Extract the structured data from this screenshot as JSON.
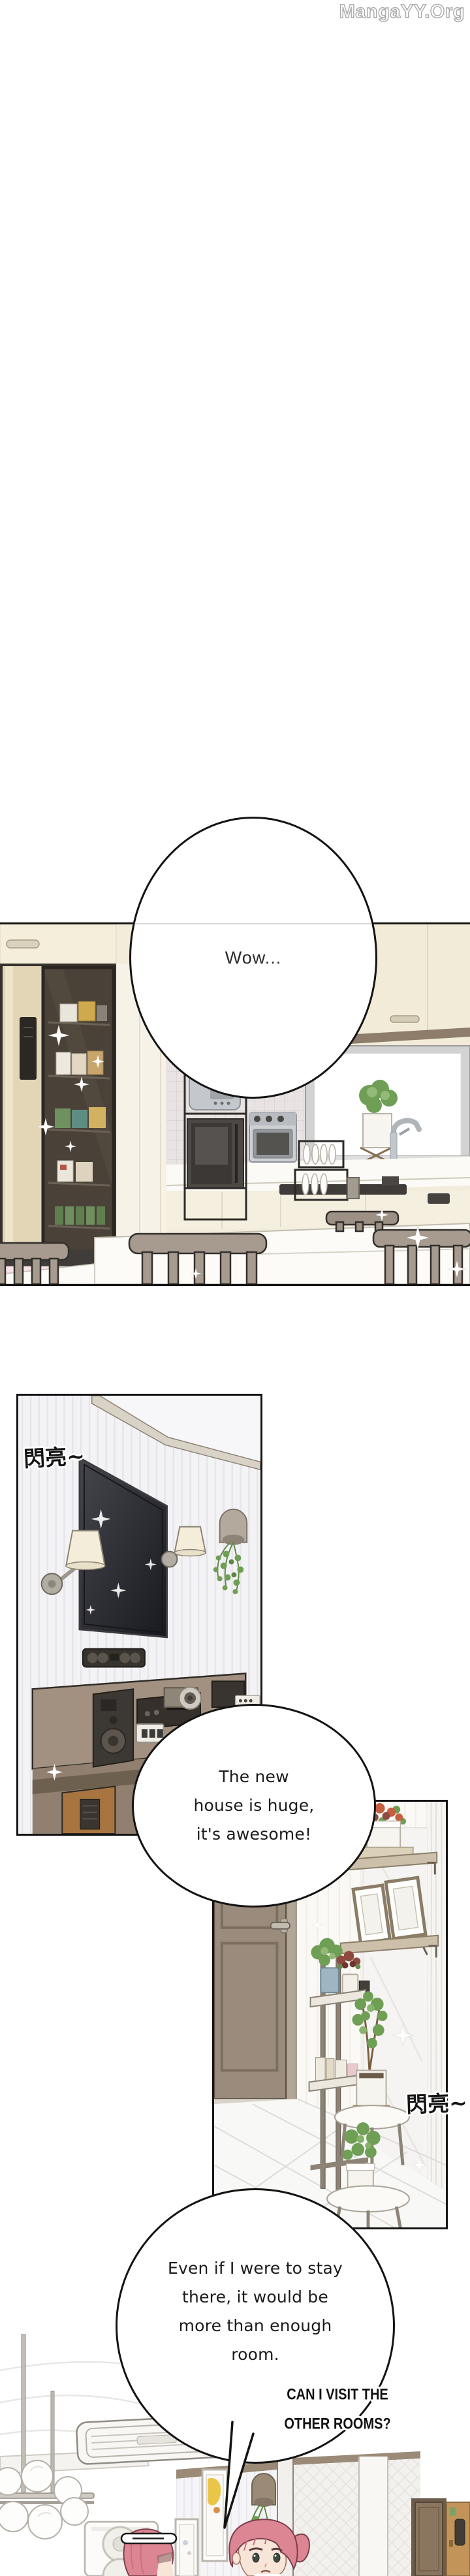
{
  "page": {
    "watermark": "MangaYY.Org"
  },
  "speech": {
    "wow": {
      "text": "Wow..."
    },
    "huge": {
      "lines": [
        "The new",
        "house is huge,",
        "it's awesome!"
      ]
    },
    "stay": {
      "lines": [
        "Even if I were to stay",
        "there, it would be",
        "more than enough",
        "room."
      ]
    },
    "shout": {
      "lines": [
        "CAN I VISIT THE",
        "OTHER ROOMS?"
      ]
    }
  },
  "sfx": {
    "tv_sparkle": "閃亮~",
    "hall_sparkle": "閃亮~"
  },
  "colors": {
    "ink": "#141414",
    "paper": "#ffffff",
    "cream": "#f2ecda",
    "kitchen_trim": "#8d7d6a",
    "fridge_beige": "#e3d6b7",
    "fridge_dark": "#4a4238",
    "pink_cabinet": "#f3d4d9",
    "chair_taupe": "#a79a8e",
    "window_frame": "#d2d2d2",
    "tv_dark": "#26262c",
    "sconce_cream": "#f3edda",
    "console_brown": "#a29180",
    "component_dark": "#3c3834",
    "tower_brown": "#a8743f",
    "plant_green": "#6f9e55",
    "door_taupe": "#9a8b7c",
    "shelf_tan": "#ccc0aa",
    "flower_orange": "#c4603f",
    "flower_red": "#8e4a3f",
    "pot_blue": "#9eb5c2",
    "trim_brown": "#9b8a77",
    "art_yellow": "#e9c648",
    "door_dark": "#8a7560",
    "door_tan": "#c29459",
    "hair_pink": "#dd8693",
    "skin": "#f7e5d7"
  }
}
